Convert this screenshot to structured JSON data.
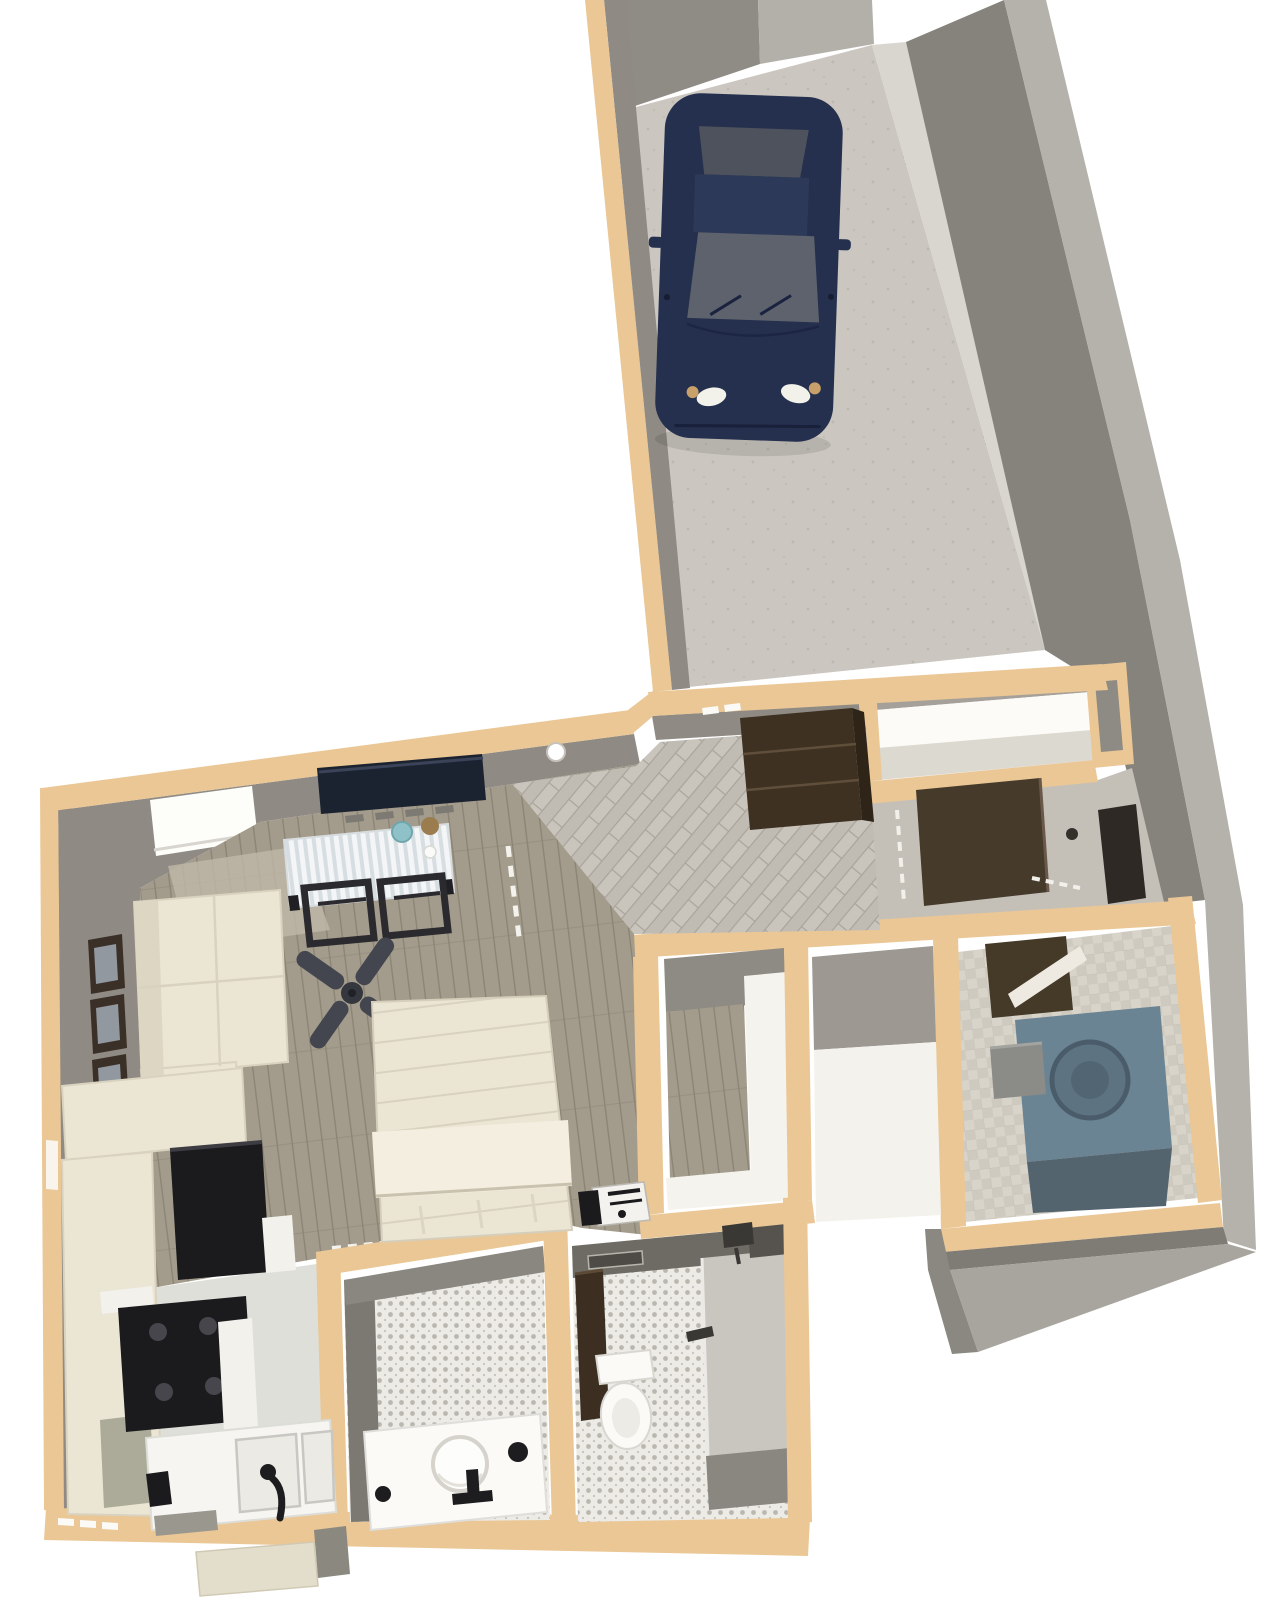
{
  "scene": {
    "description": "3D dollhouse-view floor plan render of a studio apartment with attached single-car garage",
    "rooms": [
      "garage",
      "entry-hall",
      "hall-closet",
      "storage-niche",
      "back-corridor",
      "laundry-room",
      "living-sleeping-area",
      "dining-nook",
      "kitchen",
      "walk-in-closet",
      "storage-room",
      "bathroom-vanity",
      "shower-bathroom"
    ],
    "objects": [
      "car",
      "sectional-sofa",
      "bed",
      "ceiling-fan",
      "tv",
      "dining-table",
      "dining-chairs",
      "wall-art",
      "window",
      "refrigerator",
      "range",
      "kitchen-sink",
      "hall-dresser",
      "entry-door",
      "side-door",
      "laundry-door",
      "washing-machine",
      "vanity-sink",
      "toilet",
      "shower",
      "porch-steps"
    ]
  },
  "colors": {
    "page_bg": "#ffffff",
    "wall_top_tan": "#eac795",
    "wall_face_gray": "#8f8b84",
    "wall_face_dark": "#7a766f",
    "exterior_wall_dark": "#86837d",
    "exterior_wall_light": "#b5b2ab",
    "garage_back_wall": "#8f8b85",
    "garage_door_panel": "#b3b0aa",
    "garage_floor": "#cbc7c0",
    "garage_floor_speck": "#b7b3ac",
    "curb_light": "#d9d6cf",
    "wood_floor": "#a39c8c",
    "wood_plank_line": "#8c8475",
    "wood_glow": "#bfb8a7",
    "tile_floor": "#c9c5bd",
    "tile_line": "#aeа9a0",
    "corridor_floor": "#c4c0b8",
    "mosaic_base": "#edebe6",
    "mosaic_dot": "#a9a59c",
    "laundry_floor": "#d8d4ca",
    "laundry_floor_alt": "#cfcabf",
    "closet_white_floor": "#f4f2ec",
    "room_shadow": "#9d9992",
    "cream": "#ebe5d4",
    "cream_shade": "#d9d2bf",
    "cream_light": "#f3eee0",
    "appliance_black": "#1b1b1e",
    "burner_gray": "#46464c",
    "cabinet_brown": "#3e3122",
    "cabinet_brown_side": "#2e2418",
    "door_brown": "#463a2b",
    "door_dark": "#2e2924",
    "car_navy": "#252f4e",
    "car_navy_light": "#2d3958",
    "car_glass": "#5d626c",
    "car_glass_dark": "#4d525c",
    "headlight_white": "#f2f2ea",
    "headlight_amber": "#c8a06a",
    "washer_blue": "#6a8494",
    "washer_blue_front": "#53646f",
    "washer_door": "#5d7382",
    "fixture_white": "#fbfaf7",
    "fixture_outline": "#d5d3cc",
    "black_accent": "#1d1d20",
    "fan_gray": "#43464f",
    "teal": "#8fc2c8",
    "bread_brown": "#9b7c4e",
    "step_beige": "#e3ddcb",
    "step_gray": "#8b887f",
    "white": "#ffffff"
  }
}
